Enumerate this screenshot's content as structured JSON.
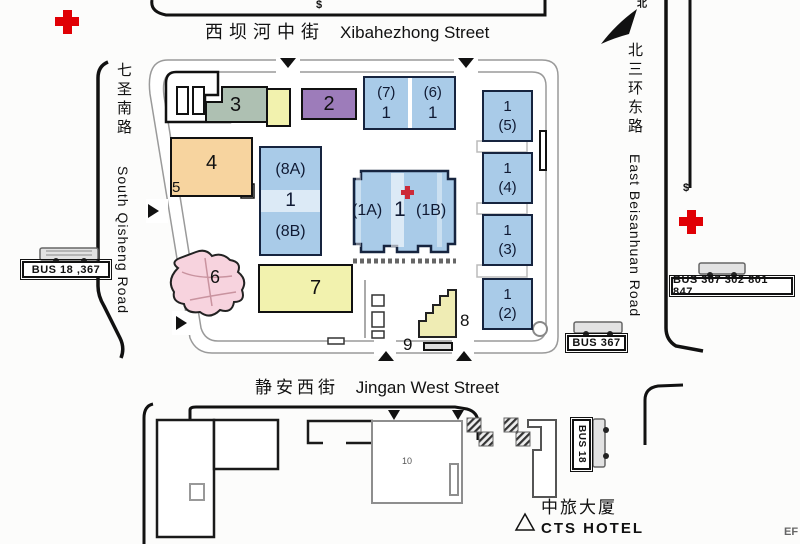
{
  "streets": {
    "top_cn": "西坝河中街",
    "top_en": "Xibahezhong Street",
    "bottom_cn": "静安西街",
    "bottom_en": "Jingan West Street",
    "left_cn": "七圣南路",
    "left_en": "South Qisheng Road",
    "right_cn": "北三环东路",
    "right_en": "East Beisanhuan Road"
  },
  "compass": {
    "north": "北"
  },
  "symbols": {
    "dollar_top": "$",
    "dollar_right": "$",
    "corner_mark": "EF"
  },
  "bus_stops": {
    "west": "BUS 18 ,367",
    "southeast": "BUS 367",
    "east": "BUS 367 302 801 847",
    "south": "BUS 18"
  },
  "hotel": {
    "cn": "中旅大厦",
    "en": "CTS HOTEL"
  },
  "buildings": {
    "b2": "2",
    "b3": "3",
    "b4": "4",
    "b5": "5",
    "b6": "6",
    "b7": "7",
    "b8": "8",
    "b9": "9",
    "b10": "10",
    "b76": {
      "l1": "(7)",
      "l2": "1",
      "r1": "(6)",
      "r2": "1"
    },
    "b8ab": {
      "top": "(8A)",
      "mid": "1",
      "bot": "(8B)"
    },
    "b1": {
      "left": "(1A)",
      "mid": "1",
      "right": "(1B)"
    },
    "col": [
      {
        "n": "1",
        "s": "(5)"
      },
      {
        "n": "1",
        "s": "(4)"
      },
      {
        "n": "1",
        "s": "(3)"
      },
      {
        "n": "1",
        "s": "(2)"
      }
    ]
  },
  "colors": {
    "blue": "#a9cbe8",
    "purple": "#9d7cba",
    "green": "#aec0b2",
    "orange": "#f7d49f",
    "yellow": "#f2f2ae",
    "pink": "#f7d3de",
    "red_cross": "#e00005",
    "border_blue": "#16243f"
  }
}
